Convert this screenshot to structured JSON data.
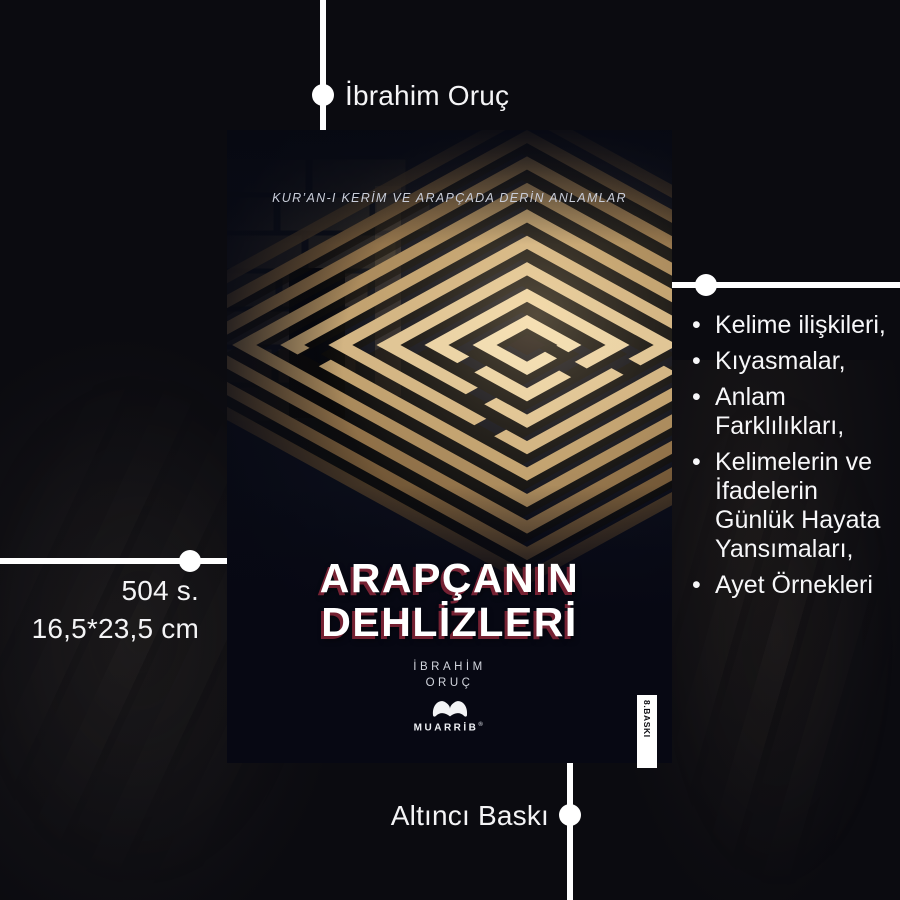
{
  "colors": {
    "page_background": "#0b0b10",
    "annotation": "#ffffff",
    "cover_background": "#0b0e1a",
    "title_text": "#ffffff",
    "title_shadow": "#92283c",
    "maze_light": "#ecd9b0",
    "stripe_background": "#ffffff",
    "stripe_text": "#0c0c12"
  },
  "annotations": {
    "author": {
      "label": "İbrahim Oruç"
    },
    "specs": {
      "pages": "504 s.",
      "dimensions": "16,5*23,5 cm"
    },
    "edition": {
      "label": "Altıncı Baskı"
    },
    "features": {
      "bullet": "•",
      "items": [
        "Kelime ilişkileri,",
        "Kıyasmalar,",
        "Anlam Farklılıkları,",
        "Kelimelerin ve İfadelerin Günlük Hayata Yansımaları,",
        "Ayet Örnekleri"
      ]
    }
  },
  "cover": {
    "tagline": "KUR’AN-I KERİM VE ARAPÇADA DERİN ANLAMLAR",
    "title": {
      "line1": "ARAPÇANIN",
      "line2": "DEHLİZLERİ"
    },
    "author": {
      "line1": "İBRAHİM",
      "line2": "ORUÇ"
    },
    "publisher": {
      "name": "MUARRİB",
      "mark": "®"
    },
    "edition_stripe": "8.BASKI"
  }
}
